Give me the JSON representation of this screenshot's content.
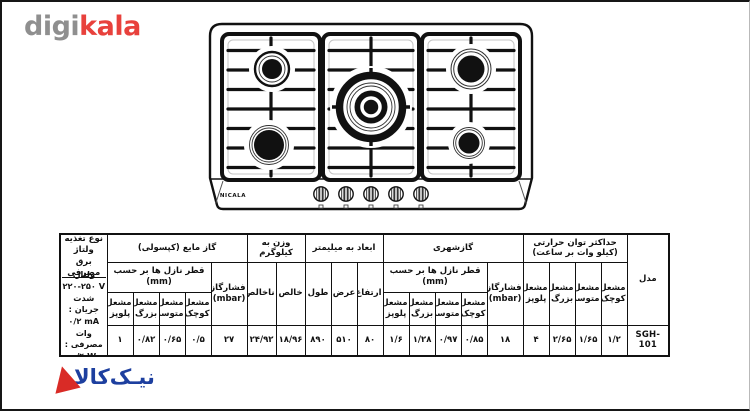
{
  "brand_header": {
    "digi": "digi",
    "kala": "kala",
    "digi_color": "#8f8f8f",
    "kala_color": "#e8413c"
  },
  "stove": {
    "brand_label": "NICALA",
    "burner_count": 5,
    "knob_count": 5
  },
  "footer_logo": {
    "text": "نیـک‌کالا",
    "text_color": "#1d3f9f",
    "triangle_color": "#d92b26"
  },
  "table": {
    "model": {
      "header": "مدل",
      "value": "SGH-101"
    },
    "max_power": {
      "group_header": "حداکثر توان حرارتی",
      "group_subheader": "(کیلو وات بر ساعت)",
      "burners": [
        {
          "l1": "مشعل",
          "l2": "کوچک",
          "value": "۱/۲"
        },
        {
          "l1": "مشعل",
          "l2": "متوسط",
          "value": "۱/۶۵"
        },
        {
          "l1": "مشعل",
          "l2": "بزرگ",
          "value": "۲/۶۵"
        },
        {
          "l1": "مشعل",
          "l2": "پلوپز",
          "value": "۴"
        }
      ]
    },
    "city_gas": {
      "group_header": "گازشهری",
      "pressure": {
        "l1": "فشارگاز",
        "l2": "(mbar)",
        "value": "۱۸"
      },
      "nozzle_header": "قطر نازل ها بر حسب (mm)",
      "burners": [
        {
          "l1": "مشعل",
          "l2": "کوچک",
          "value": "۰/۸۵"
        },
        {
          "l1": "مشعل",
          "l2": "متوسط",
          "value": "۰/۹۷"
        },
        {
          "l1": "مشعل",
          "l2": "بزرگ",
          "value": "۱/۲۸"
        },
        {
          "l1": "مشعل",
          "l2": "پلوپز",
          "value": "۱/۶"
        }
      ]
    },
    "dimensions": {
      "group_header": "ابعاد به میلیمتر",
      "cols": [
        {
          "label": "ارتفاع",
          "value": "۸۰"
        },
        {
          "label": "عرض",
          "value": "۵۱۰"
        },
        {
          "label": "طول",
          "value": "۸۹۰"
        }
      ]
    },
    "weight": {
      "group_header": "وزن به کیلوگرم",
      "cols": [
        {
          "label": "خالص",
          "value": "۱۸/۹۶"
        },
        {
          "label": "ناخالص",
          "value": "۲۴/۹۲"
        }
      ]
    },
    "lpg": {
      "group_header": "گاز مایع (کپسولی)",
      "pressure": {
        "l1": "فشارگاز",
        "l2": "(mbar)",
        "value": "۲۷"
      },
      "nozzle_header": "قطر نازل ها بر حسب (mm)",
      "burners": [
        {
          "l1": "مشعل",
          "l2": "کوچک",
          "value": "۰/۵"
        },
        {
          "l1": "مشعل",
          "l2": "متوسط",
          "value": "۰/۶۵"
        },
        {
          "l1": "مشعل",
          "l2": "بزرگ",
          "value": "۰/۸۲"
        },
        {
          "l1": "مشعل",
          "l2": "پلوپز",
          "value": "۱"
        }
      ]
    },
    "electrical": {
      "header_l1": "نوع تغذیه ولتاژ",
      "header_l2": "برق مصرفی",
      "lines": [
        {
          "label": "ولتاژ:",
          "value": "۲۲۰-۲۵۰ V"
        },
        {
          "label": "شدت جریان :",
          "value": "۰/۲ mA"
        },
        {
          "label": "وات مصرفی :",
          "value": "۰/۴ W"
        }
      ]
    }
  }
}
